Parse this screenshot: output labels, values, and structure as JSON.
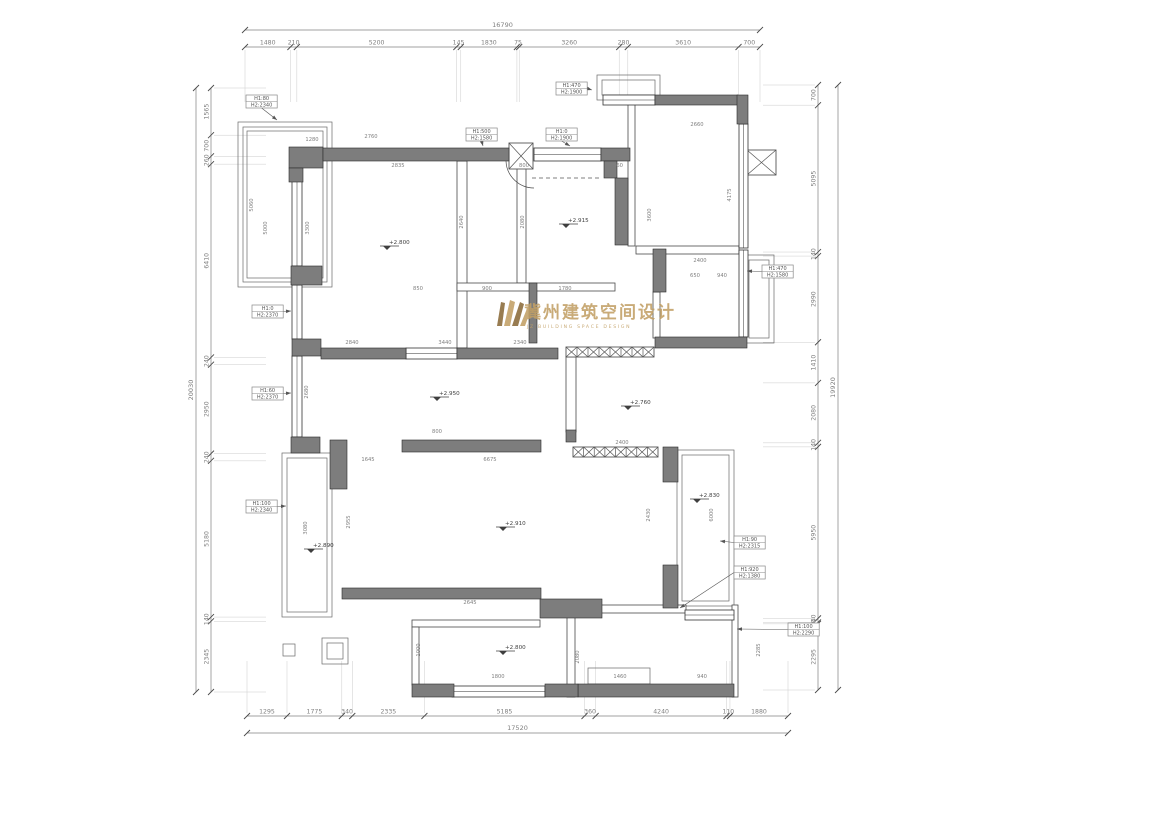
{
  "logo": {
    "cn": "冀州建筑空间设计",
    "en": "JZ BUILDING SPACE DESIGN"
  },
  "colors": {
    "wall": "#7d7d7d",
    "wallEdge": "#2a2a2a",
    "thin": "#4a4a4a",
    "outline": "#6a6a6a",
    "dim": "#808080",
    "ext": "#cccccc",
    "dash": "#555555",
    "hatch": "#555555",
    "gold": "#c2a066",
    "tagBorder": "#888888",
    "tagText": "#555555",
    "level": "#3f3f3f"
  },
  "chains": {
    "top": {
      "y": 47,
      "ty": 30,
      "x1": 245,
      "x2": 760,
      "total": "16790",
      "segs": [
        1480,
        210,
        5200,
        145,
        1830,
        75,
        3260,
        280,
        3610,
        700
      ]
    },
    "bottom": {
      "y": 716,
      "ty": 733,
      "x1": 247,
      "x2": 788,
      "total": "17520",
      "segs": [
        1295,
        1775,
        340,
        2335,
        5185,
        360,
        4240,
        110,
        1880
      ]
    },
    "left": {
      "x": 211,
      "tx": 196,
      "y1": 88,
      "y2": 692,
      "total": "20030",
      "segs": [
        1565,
        700,
        260,
        6410,
        240,
        2950,
        240,
        5180,
        140,
        2345
      ]
    },
    "right": {
      "x": 818,
      "tx": 838,
      "y1": 85,
      "y2": 690,
      "total": "19920",
      "segs": [
        700,
        5095,
        140,
        2990,
        1410,
        2080,
        140,
        5950,
        140,
        50,
        2295
      ]
    }
  },
  "walls": [
    [
      289,
      147,
      34,
      21
    ],
    [
      289,
      168,
      14,
      14
    ],
    [
      323,
      148,
      186,
      13
    ],
    [
      601,
      148,
      29,
      13
    ],
    [
      604,
      161,
      13,
      17
    ],
    [
      615,
      178,
      13,
      67
    ],
    [
      655,
      95,
      83,
      10
    ],
    [
      737,
      95,
      11,
      29
    ],
    [
      653,
      249,
      13,
      43
    ],
    [
      655,
      337,
      92,
      11
    ],
    [
      291,
      266,
      31,
      19
    ],
    [
      292,
      339,
      29,
      17
    ],
    [
      321,
      348,
      85,
      11
    ],
    [
      457,
      348,
      101,
      11
    ],
    [
      291,
      437,
      29,
      16
    ],
    [
      402,
      440,
      139,
      12
    ],
    [
      330,
      440,
      17,
      49
    ],
    [
      663,
      447,
      15,
      35
    ],
    [
      663,
      565,
      15,
      43
    ],
    [
      342,
      588,
      199,
      11
    ],
    [
      540,
      599,
      62,
      19
    ],
    [
      578,
      684,
      156,
      13
    ],
    [
      412,
      684,
      42,
      13
    ],
    [
      545,
      684,
      33,
      13
    ],
    [
      529,
      283,
      8,
      60
    ],
    [
      566,
      430,
      10,
      12
    ]
  ],
  "windows": [
    [
      534,
      148,
      67,
      13
    ],
    [
      739,
      124,
      9,
      124
    ],
    [
      739,
      250,
      9,
      87
    ],
    [
      406,
      348,
      51,
      11
    ],
    [
      452,
      686,
      93,
      11
    ],
    [
      685,
      610,
      49,
      10
    ],
    [
      292,
      170,
      10,
      96
    ],
    [
      292,
      285,
      10,
      54
    ],
    [
      292,
      356,
      10,
      81
    ],
    [
      603,
      95,
      52,
      10
    ]
  ],
  "thin_walls": [
    [
      457,
      161,
      10,
      187
    ],
    [
      517,
      168,
      9,
      115
    ],
    [
      457,
      283,
      158,
      8
    ],
    [
      566,
      357,
      10,
      75
    ],
    [
      628,
      103,
      7,
      143
    ],
    [
      636,
      246,
      103,
      8
    ],
    [
      567,
      605,
      8,
      92
    ],
    [
      732,
      605,
      6,
      92
    ],
    [
      601,
      605,
      85,
      8
    ],
    [
      412,
      620,
      128,
      7
    ],
    [
      412,
      627,
      7,
      58
    ],
    [
      653,
      292,
      7,
      46
    ]
  ],
  "outlines": [
    [
      238,
      122,
      94,
      165
    ],
    [
      243,
      127,
      84,
      155
    ],
    [
      247,
      131,
      76,
      147
    ],
    [
      282,
      453,
      50,
      164
    ],
    [
      287,
      458,
      40,
      154
    ],
    [
      597,
      75,
      63,
      25
    ],
    [
      602,
      80,
      53,
      15
    ],
    [
      744,
      255,
      30,
      88
    ],
    [
      749,
      260,
      20,
      78
    ],
    [
      677,
      450,
      57,
      156
    ],
    [
      682,
      455,
      47,
      146
    ],
    [
      283,
      644,
      12,
      12
    ],
    [
      322,
      638,
      26,
      26
    ],
    [
      327,
      643,
      16,
      16
    ],
    [
      588,
      668,
      62,
      16
    ]
  ],
  "hatches": [
    [
      509,
      143,
      24,
      26
    ],
    [
      566,
      347,
      88,
      10
    ],
    [
      573,
      447,
      85,
      10
    ],
    [
      747,
      150,
      29,
      25
    ]
  ],
  "dashed": [
    [
      296,
      289,
      296,
      338
    ],
    [
      532,
      178,
      600,
      178
    ]
  ],
  "arcs": [
    "M506,161 A28,28 0 0 0 534,188"
  ],
  "tags": [
    {
      "x": 246,
      "y": 95,
      "l1": "H1:80",
      "l2": "H2:2340",
      "px": 277,
      "py": 120,
      "dir": "d"
    },
    {
      "x": 556,
      "y": 82,
      "l1": "H1:470",
      "l2": "H2:1900",
      "px": 592,
      "py": 90,
      "dir": "r"
    },
    {
      "x": 466,
      "y": 128,
      "l1": "H1:500",
      "l2": "H2:1580",
      "px": 483,
      "py": 146,
      "dir": "d"
    },
    {
      "x": 546,
      "y": 128,
      "l1": "H1:0",
      "l2": "H2:1900",
      "px": 570,
      "py": 146,
      "dir": "d"
    },
    {
      "x": 762,
      "y": 265,
      "l1": "H1:470",
      "l2": "H2:1580",
      "px": 747,
      "py": 271,
      "dir": "l"
    },
    {
      "x": 252,
      "y": 305,
      "l1": "H1:0",
      "l2": "H2:2370",
      "px": 291,
      "py": 311,
      "dir": "r"
    },
    {
      "x": 252,
      "y": 387,
      "l1": "H1:60",
      "l2": "H2:2370",
      "px": 291,
      "py": 393,
      "dir": "r"
    },
    {
      "x": 246,
      "y": 500,
      "l1": "H1:100",
      "l2": "H2:2340",
      "px": 286,
      "py": 506,
      "dir": "r"
    },
    {
      "x": 734,
      "y": 536,
      "l1": "H1:90",
      "l2": "H2:2315",
      "px": 720,
      "py": 541,
      "dir": "l"
    },
    {
      "x": 734,
      "y": 566,
      "l1": "H1:920",
      "l2": "H2:1380",
      "px": 680,
      "py": 608,
      "dir": "l"
    },
    {
      "x": 788,
      "y": 623,
      "l1": "H1:100",
      "l2": "H2:2290",
      "px": 737,
      "py": 629,
      "dir": "l"
    }
  ],
  "levels": [
    {
      "x": 387,
      "y": 246,
      "v": "+2.800"
    },
    {
      "x": 566,
      "y": 224,
      "v": "+2.915"
    },
    {
      "x": 437,
      "y": 397,
      "v": "+2.950"
    },
    {
      "x": 628,
      "y": 406,
      "v": "+2.760"
    },
    {
      "x": 311,
      "y": 549,
      "v": "+2.890"
    },
    {
      "x": 503,
      "y": 527,
      "v": "+2.910"
    },
    {
      "x": 697,
      "y": 499,
      "v": "+2.830"
    },
    {
      "x": 503,
      "y": 651,
      "v": "+2.800"
    }
  ],
  "small_dims": [
    [
      371,
      138,
      "2760",
      0
    ],
    [
      253,
      205,
      "5060",
      90
    ],
    [
      312,
      141,
      "1280",
      0
    ],
    [
      398,
      167,
      "2835",
      0
    ],
    [
      524,
      167,
      "800",
      0
    ],
    [
      618,
      167,
      "560",
      0
    ],
    [
      309,
      228,
      "3300",
      90
    ],
    [
      267,
      228,
      "5000",
      90
    ],
    [
      463,
      222,
      "2640",
      90
    ],
    [
      524,
      222,
      "2080",
      90
    ],
    [
      651,
      215,
      "3600",
      90
    ],
    [
      697,
      126,
      "2660",
      0
    ],
    [
      731,
      195,
      "4175",
      90
    ],
    [
      418,
      290,
      "850",
      0
    ],
    [
      487,
      290,
      "900",
      0
    ],
    [
      565,
      290,
      "1780",
      0
    ],
    [
      695,
      277,
      "650",
      0
    ],
    [
      722,
      277,
      "940",
      0
    ],
    [
      700,
      262,
      "2400",
      0
    ],
    [
      352,
      344,
      "2840",
      0
    ],
    [
      445,
      344,
      "3440",
      0
    ],
    [
      520,
      344,
      "2340",
      0
    ],
    [
      308,
      392,
      "2680",
      90
    ],
    [
      437,
      433,
      "800",
      0
    ],
    [
      368,
      461,
      "1645",
      0
    ],
    [
      490,
      461,
      "6675",
      0
    ],
    [
      307,
      528,
      "3080",
      90
    ],
    [
      350,
      522,
      "2955",
      90
    ],
    [
      470,
      604,
      "2645",
      0
    ],
    [
      650,
      515,
      "2430",
      90
    ],
    [
      622,
      444,
      "2400",
      0
    ],
    [
      713,
      515,
      "6000",
      90
    ],
    [
      498,
      678,
      "1800",
      0
    ],
    [
      620,
      678,
      "1460",
      0
    ],
    [
      702,
      678,
      "940",
      0
    ],
    [
      579,
      657,
      "2080",
      90
    ],
    [
      760,
      650,
      "2285",
      90
    ],
    [
      420,
      650,
      "1000",
      90
    ]
  ]
}
